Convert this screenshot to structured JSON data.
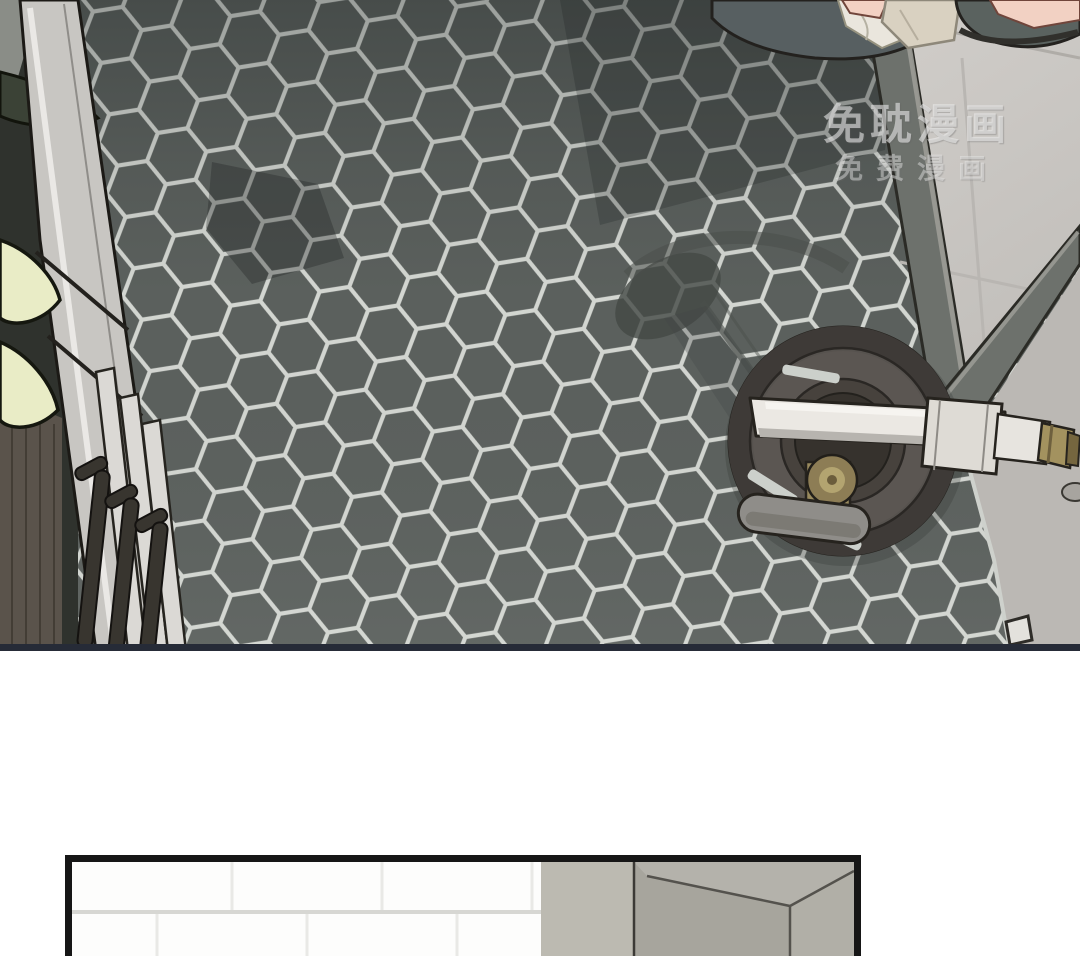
{
  "page": {
    "background": "#ffffff",
    "kind": "webtoon-comic-page"
  },
  "watermark": {
    "line1": "免耽漫画",
    "line2": "免费漫画"
  },
  "colors": {
    "hex_tile": "#5b605d",
    "grout": "#d3d6d1",
    "panel_border": "#262b37",
    "light_floor_upper": "#cbc8c4",
    "light_floor_lower": "#bbb8b4",
    "curb": "#6d716c",
    "drain_ring": "#3e3a37",
    "drain_center": "#36322d",
    "brass": "#8d7d55",
    "spout": "#ebe8e3",
    "lever": "#8f8d89",
    "skin": "#f2d1c3",
    "slipper": "#5a625f",
    "towel": "#d9d1c1",
    "cloth": "#eae6dd",
    "cabinet_wood": "#5a534b",
    "door_slab": "#c8c6c2",
    "leaf": "#e9ecc6",
    "shadow": "#434845",
    "wall_tile": "#fdfdfc",
    "wall_grout": "#d7d7d3",
    "wall_strip": "#bcbab1",
    "wall_box": "#a7a59d",
    "panel2_border": "#161616"
  },
  "panels": [
    {
      "id": "panel-1",
      "label": "bathroom hex-tile floor with fallen shower faucet and drain"
    },
    {
      "id": "panel-2",
      "label": "white subway-tile wall with gray column"
    }
  ]
}
